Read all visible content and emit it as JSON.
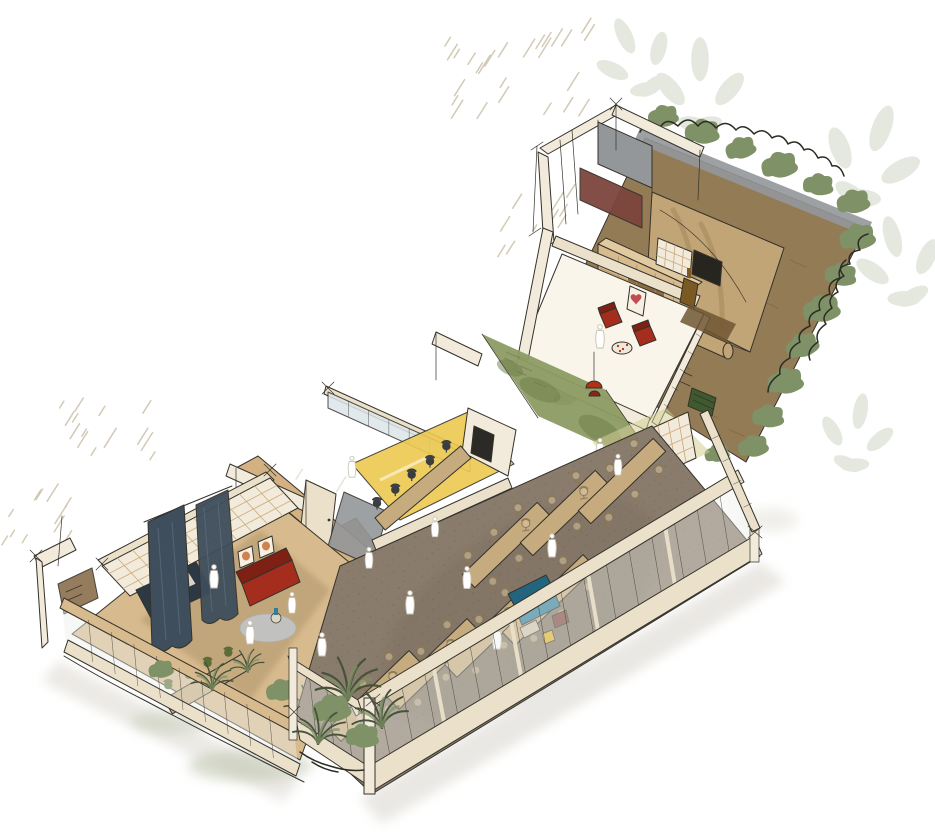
{
  "artwork": {
    "kind": "cutaway axonometric interior illustration",
    "style": "hand-drawn watercolor sketch",
    "background": "#ffffff",
    "text_content": ""
  },
  "palette": {
    "paper": "#ffffff",
    "ink": "#35322b",
    "inkSoft": "#6a665c",
    "inkPlant": "#2a2d24",
    "cream": "#f2ebdb",
    "cream2": "#ebe1cb",
    "creamEdge": "#c9a97b",
    "tan": "#d7ba8d",
    "tanBand": "#d3b183",
    "woodDark": "#6f4f26",
    "oliveFloor": "#8d7344",
    "diningFloor": "#8a7c6c",
    "diningSpeck": "#6e6254",
    "tableTan": "#c6ab7f",
    "chairBeige": "#8d7856",
    "chairDark": "#3a3e41",
    "chairGreen": "#5c6d39",
    "soil": "#927b55",
    "soilDark": "#75603c",
    "canopy": "#c2a577",
    "canopyShade": "#a98c5f",
    "hedgeGray": "#8e9089",
    "leafLight": "#b3bfa0",
    "leafMid": "#7f9166",
    "leafDark": "#46523a",
    "moss": "#8c9b63",
    "mossDark": "#6f7f4b",
    "yellow": "#edc94f",
    "yellowPale": "#f3dc84",
    "yellowTag": "#e2b22b",
    "teal": "#2e7d9c",
    "tealDark": "#23657f",
    "navy": "#3e4e5c",
    "navyDark": "#2c3945",
    "red": "#a52d1d",
    "redDark": "#7e2114",
    "maroon": "#7c453c",
    "heart": "#c14b50",
    "grayWall": "#94979a",
    "rugGray": "#c2c5c6",
    "rugBrown": "#6f5633",
    "glass": "#eef0ec",
    "glassBlue": "#dde6ea",
    "shadow": "#d9d6cd",
    "shadowGreen": "#b9c2a8",
    "frameArt": "#c96f3a",
    "discTan": "#c8a26b",
    "hatchTan": "#c9bda4",
    "hatchFaint": "#ddd6c6"
  },
  "scene": {
    "areas": [
      {
        "id": "garden-terrace",
        "elements": [
          "shade-sail-canopy",
          "earth-ground",
          "perimeter-hedge",
          "green-bench",
          "climbing-plants"
        ]
      },
      {
        "id": "utility-rooms",
        "elements": [
          "grey-shower-panel",
          "terracotta-floor-panel",
          "timber-wardrobe-wall"
        ]
      },
      {
        "id": "lounge-room",
        "elements": [
          "wall-screen",
          "shelving-unit",
          "heart-artwork",
          "red-armchairs",
          "patterned-round-table",
          "coat-stand",
          "brown-rug"
        ]
      },
      {
        "id": "moss-wall-corridor",
        "elements": [
          "green-moss-wall",
          "red-pendant-lamp",
          "sketched-wall-notes"
        ]
      },
      {
        "id": "meeting-room",
        "elements": [
          "yellow-floor",
          "conference-table",
          "dark-task-chairs",
          "wall-screen",
          "glass-partition"
        ]
      },
      {
        "id": "focus-booths",
        "elements": [
          "yellow-niches",
          "round-tables",
          "green-chairs",
          "teal-booth-panels",
          "red-chair"
        ]
      },
      {
        "id": "dining-hall",
        "elements": [
          "long-timber-tables",
          "task-chairs",
          "teal-sofa",
          "glazed-facade",
          "people-silhouettes",
          "maroon-artwork",
          "yellow-sign"
        ]
      },
      {
        "id": "left-lounge-wing",
        "elements": [
          "timber-lattice-wall",
          "navy-curtains",
          "navy-daybed",
          "red-sofa",
          "framed-artworks",
          "round-grey-rug",
          "long-table",
          "green-chairs",
          "indoor-plants"
        ]
      }
    ],
    "counts": {
      "dining_tables": 7,
      "dining_chairs": 42,
      "desk_tables": 2,
      "desk_chairs": 8,
      "meeting_chairs": 5,
      "green_chairs": 6,
      "people_silhouettes": 12,
      "red_armchairs": 2,
      "framed_artworks": 3,
      "pendant_lamps": 1
    }
  }
}
